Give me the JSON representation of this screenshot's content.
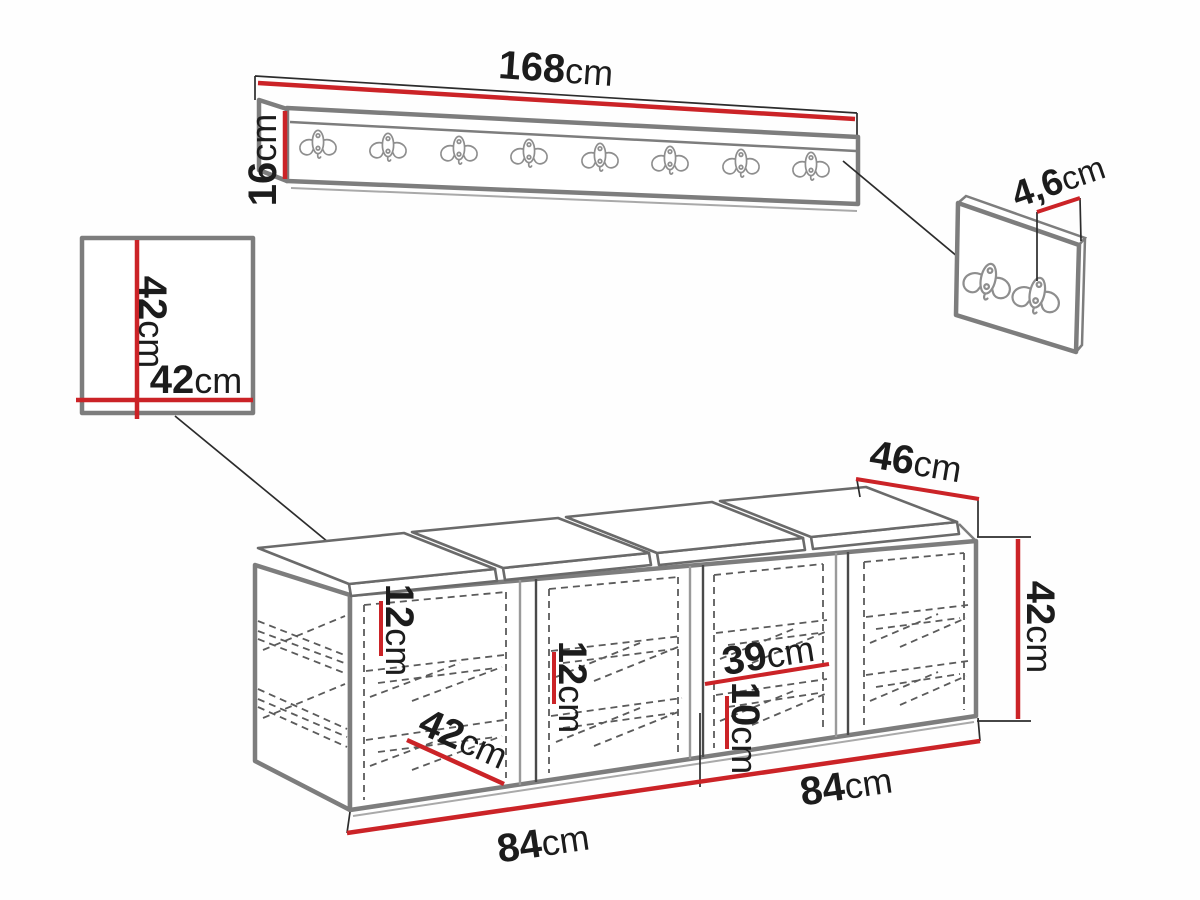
{
  "diagram": {
    "type": "furniture dimension drawing",
    "colors": {
      "dimension_red": "#cb2327",
      "outline_gray": "#7d7d7d",
      "text": "#1c1c1c"
    },
    "parts": {
      "coat_rack": {
        "hook_count": 8
      },
      "mirror_panel": {},
      "hook_panel": {
        "hook_count": 2
      },
      "bench": {
        "compartment_count": 4,
        "cushion_count": 4
      }
    }
  },
  "dims": {
    "rack_width": {
      "num": "168",
      "unit": "cm"
    },
    "rack_height": {
      "num": "16",
      "unit": "cm"
    },
    "mirror_height": {
      "num": "42",
      "unit": "cm"
    },
    "mirror_width": {
      "num": "42",
      "unit": "cm"
    },
    "panel_thickness": {
      "num": "4,6",
      "unit": "cm"
    },
    "bench_depth": {
      "num": "46",
      "unit": "cm"
    },
    "bench_height": {
      "num": "42",
      "unit": "cm"
    },
    "shelf_gap_1": {
      "num": "12",
      "unit": "cm"
    },
    "shelf_gap_2": {
      "num": "12",
      "unit": "cm"
    },
    "compartment_width": {
      "num": "39",
      "unit": "cm"
    },
    "bottom_shelf_gap": {
      "num": "10",
      "unit": "cm"
    },
    "inner_depth": {
      "num": "42",
      "unit": "cm"
    },
    "bench_width_left": {
      "num": "84",
      "unit": "cm"
    },
    "bench_width_right": {
      "num": "84",
      "unit": "cm"
    }
  }
}
